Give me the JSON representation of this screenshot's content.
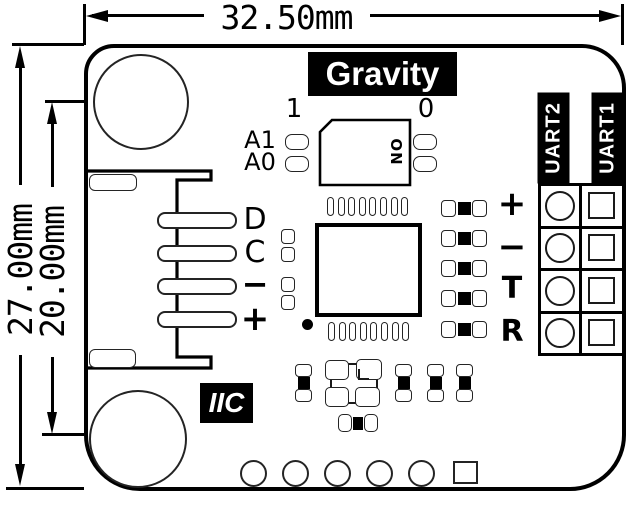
{
  "drawing": {
    "width_dim": "32.50mm",
    "outer_height_dim": "27.00mm",
    "inner_height_dim": "20.00mm"
  },
  "board": {
    "brand": "Gravity",
    "interface_badge": "IIC",
    "dip_switch": {
      "left_index": "1",
      "right_index": "0",
      "on_label": "ON",
      "row1_label": "A1",
      "row2_label": "A0"
    },
    "gravity_connector": {
      "pin_d": "D",
      "pin_c": "C",
      "pin_minus": "−",
      "pin_plus": "+"
    },
    "uart_block": {
      "header2": "UART2",
      "header1": "UART1",
      "pin_plus": "+",
      "pin_minus": "−",
      "pin_t": "T",
      "pin_r": "R"
    }
  },
  "colors": {
    "ink": "#000000",
    "background": "#ffffff"
  }
}
